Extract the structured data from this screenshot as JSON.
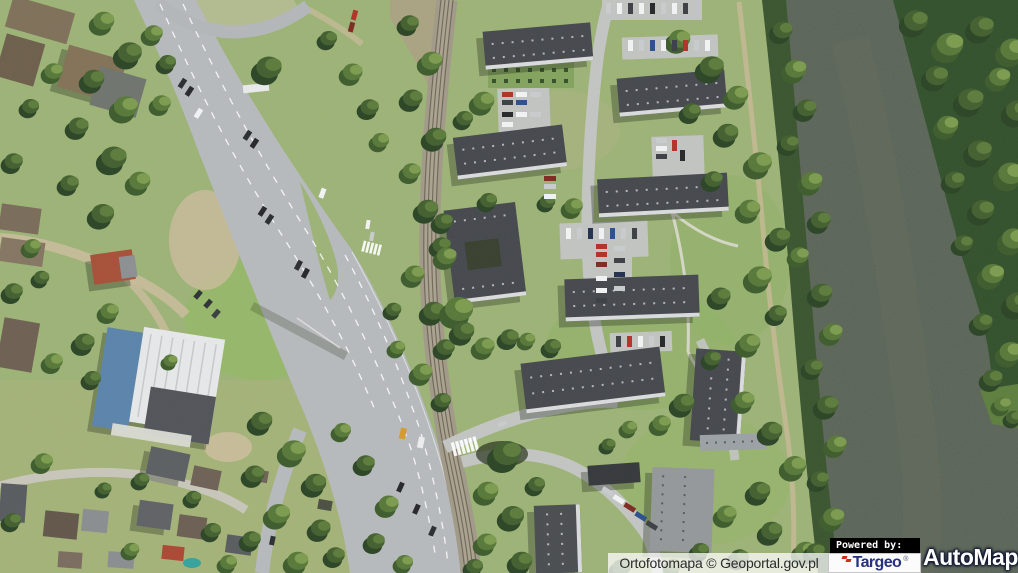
{
  "map_viewer": {
    "attribution": "Ortofotomapa © Geoportal.gov.pl",
    "powered_by": "Powered by:",
    "brand_targeo": "Targeo",
    "brand_targeo_reg": "®",
    "brand_automapa": "AutoMapa",
    "brand_automapa_reg": "®"
  },
  "colors": {
    "grass": "#9db377",
    "water": "#566053",
    "road": "#b7babc",
    "roof_dark": "#45484d",
    "targeo_navy": "#26327f",
    "targeo_red": "#d42a1e"
  }
}
